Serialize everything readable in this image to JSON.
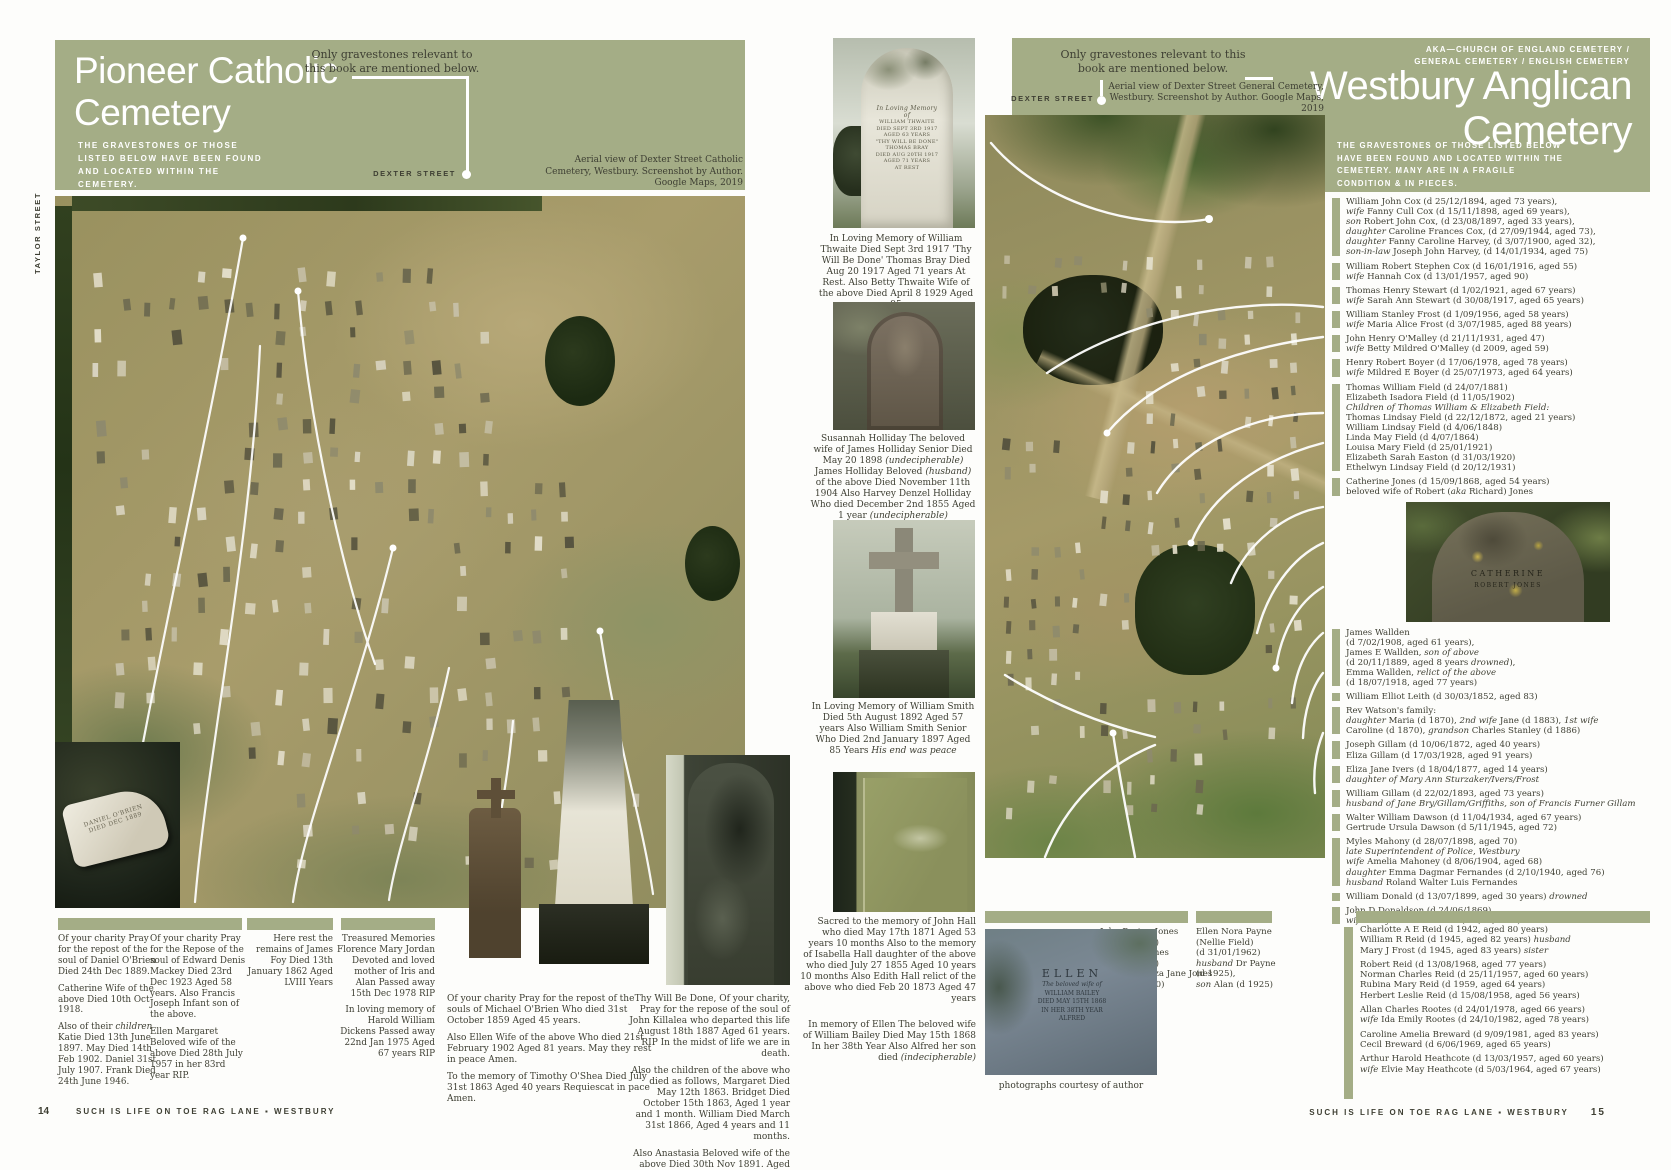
{
  "palette": {
    "sage": "#a4ad86",
    "ink": "#3e3f33",
    "annotation": "#ffffff"
  },
  "left_page": {
    "title": "Pioneer Catholic Cemetery",
    "callout": "Only gravestones relevant to this book are mentioned below.",
    "subtitle": "THE GRAVESTONES OF THOSE LISTED BELOW HAVE BEEN FOUND AND LOCATED WITHIN THE CEMETERY.",
    "street_side": "TAYLOR STREET",
    "street_bottom": "DEXTER STREET",
    "aerial_caption": "Aerial view of Dexter Street Catholic Cemetery, Westbury. Screenshot by Author. Google Maps, 2019",
    "fallen_stone_inscription": [
      "DANIEL O'BRIEN",
      "DIED DEC 1889"
    ],
    "caption_blocks": [
      {
        "paragraphs": [
          "Of your charity Pray for the repost of the soul of Daniel O'Brien Died 24th Dec 1889.",
          "Catherine Wife of the above Died 10th Oct 1918.",
          "Also of their *children* Katie Died 13th June 1897. May Died 14th Feb 1902. Daniel 31st July 1907. Frank Died 24th June 1946."
        ]
      },
      {
        "paragraphs": [
          "Of your charity Pray for the Repose of the soul of Edward Denis Mackey Died 23rd Dec 1923 Aged 58 years. Also Francis Joseph Infant son of the above.",
          "Ellen Margaret Beloved wife of the above Died 28th July 1957 in her 83rd year RIP."
        ]
      },
      {
        "paragraphs": [
          "Here rest the remains of James Foy Died 13th January 1862 Aged LVIII Years"
        ]
      },
      {
        "paragraphs": [
          "Treasured Memories Florence Mary Jordan Devoted and loved mother of Iris and Alan Passed away 15th Dec 1978 RIP",
          "In loving memory of Harold William Dickens Passed away 22nd Jan 1975 Aged 67 years RIP"
        ]
      },
      {
        "paragraphs": [
          "Of your charity Pray for the repost of the souls of Michael O'Brien Who died 31st October 1859 Aged 45 years.",
          "Also Ellen Wife of the above Who died 21st February 1902 Aged 81 years. May they rest in peace Amen.",
          "To the memory of Timothy O'Shea Died July 31st 1863 Aged 40 years Requiescat in pace Amen."
        ]
      },
      {
        "paragraphs": [
          "Thy Will Be Done, Of your charity, Pray for the repose of the soul of John Killalea who departed this life August 18th 1887 Aged 61 years. RIP In the midst of life we are in death.",
          "Also the children of the above who died as follows, Margaret Died May 12th 1863. Bridget Died October 15th 1863, Aged 1 year and 1 month. William Died March 31st 1866, Aged 4 years and 11 months.",
          "Also Anastasia Beloved wife of the above Died 30th Nov 1891. Aged 65 years."
        ]
      }
    ],
    "footer": {
      "page": "14",
      "text": "SUCH IS LIFE ON TOE RAG LANE ▪ WESTBURY"
    }
  },
  "right_page": {
    "aka1": "AKA—CHURCH OF ENGLAND CEMETERY /",
    "aka2": "GENERAL CEMETERY / ENGLISH CEMETERY",
    "title": "Westbury Anglican Cemetery",
    "subtitle": "THE GRAVESTONES OF THOSE LISTED BELOW HAVE BEEN FOUND AND LOCATED WITHIN THE CEMETERY. MANY ARE IN A FRAGILE CONDITION & IN PIECES.",
    "callout": "Only gravestones relevant to this book are mentioned below.",
    "street_top": "DEXTER STREET",
    "street_side": "MARY STREET",
    "aerial_caption": "Aerial view of Dexter Street General Cemetery, Westbury. Screenshot by Author. Google Maps, 2019",
    "thwaite_inscription": [
      "In Loving Memory",
      "of",
      "WILLIAM THWAITE",
      "DIED SEPT 3RD 1917",
      "AGED 63 YEARS",
      "\"THY WILL BE DONE\"",
      "THOMAS BRAY",
      "DIED AUG 20TH 1917",
      "AGED 71 YEARS",
      "AT REST"
    ],
    "ellen_inscription": [
      "ELLEN",
      "The beloved wife of",
      "WILLIAM BAILEY",
      "DIED MAY 15TH 1868",
      "IN HER 38TH YEAR",
      "ALFRED"
    ],
    "catherine_inscription": [
      "CATHERINE",
      "ROBERT JONES"
    ],
    "photo_captions": [
      {
        "paragraphs": [
          "In Loving Memory of William Thwaite Died Sept 3rd 1917 'Thy Will Be Done' Thomas Bray Died Aug 20 1917 Aged 71 years At Rest. Also Betty Thwaite Wife of the above Died April 8 1929 Aged 95"
        ]
      },
      {
        "paragraphs": [
          "Susannah Holliday The beloved wife of James Holliday Senior Died May 20 1898 *(undecipherable)* James Holliday Beloved *(husband)* of the above Died November 11th 1904 Also Harvey Denzel Holliday Who died December 2nd 1855 Aged 1 year *(undecipherable)*"
        ]
      },
      {
        "paragraphs": [
          "In Loving Memory of William Smith Died 5th August 1892 Aged 57 years Also William Smith Senior Who Died 2nd January 1897 Aged 85 Years *His end was peace*"
        ]
      },
      {
        "paragraphs": [
          "Sacred to the memory of John Hall who died May 17th 1871 Aged 53 years 10 months Also to the memory of Isabella Hall daughter of the above who died July 27 1855 Aged 10 years 10 months Also Edith Hall relict of the above who died Feb 20 1873 Aged 47 years"
        ]
      },
      {
        "paragraphs": [
          "In memory of Ellen The beloved wife of William Bailey Died May 15th 1868 In her 38th Year Also Alfred her son died *(indecipherable)*"
        ]
      }
    ],
    "list": [
      {
        "lines": [
          "William John Cox (d 25/12/1894, aged 73 years),",
          "*wife* Fanny Cull Cox (d 15/11/1898, aged 69 years),",
          "*son* Robert John Cox, (d 23/08/1897, aged 33 years),",
          "*daughter* Caroline Frances Cox, (d 27/09/1944, aged 73),",
          "*daughter* Fanny Caroline Harvey, (d 3/07/1900, aged 32),",
          "*son-in-law* Joseph John Harvey, (d 14/01/1934, aged 75)"
        ]
      },
      {
        "lines": [
          "William Robert Stephen Cox (d 16/01/1916, aged 55)",
          "*wife* Hannah Cox (d 13/01/1957, aged 90)"
        ]
      },
      {
        "lines": [
          "Thomas Henry Stewart (d 1/02/1921, aged 67 years)",
          "*wife* Sarah Ann Stewart (d 30/08/1917, aged 65 years)"
        ]
      },
      {
        "lines": [
          "William Stanley Frost (d 1/09/1956, aged 58 years)",
          "*wife* Maria Alice Frost (d 3/07/1985, aged 88 years)"
        ]
      },
      {
        "lines": [
          "John Henry O'Malley (d 21/11/1931, aged 47)",
          "*wife* Betty Mildred O'Malley (d 2009, aged 59)"
        ]
      },
      {
        "lines": [
          "Henry Robert Boyer (d 17/06/1978, aged 78 years)",
          "*wife* Mildred E Boyer (d 25/07/1973, aged 64 years)"
        ]
      },
      {
        "lines": [
          "Thomas William Field (d 24/07/1881)",
          "Elizabeth Isadora Field (d 11/05/1902)",
          "*Children of Thomas William & Elizabeth Field:*",
          "Thomas Lindsay Field (d 22/12/1872, aged 21 years)",
          "William Lindsay Field (d 4/06/1848)",
          "Linda May Field (d 4/07/1864)",
          "Louisa Mary Field (d 25/01/1921)",
          "Elizabeth Sarah Easton (d 31/03/1920)",
          "Ethelwyn Lindsay Field (d 20/12/1931)"
        ]
      },
      {
        "lines": [
          "Catherine Jones (d 15/09/1868, aged 54 years)",
          "beloved wife of Robert (*aka* Richard) Jones"
        ],
        "photo": "catherine"
      },
      {
        "lines": [
          "James Wallden",
          "(d 7/02/1908, aged 61 years),",
          "James E Wallden, *son of above*",
          "(d 20/11/1889, aged 8 years *drowned*),",
          "Emma Wallden, *relict of the above*",
          "(d 18/07/1918, aged 77 years)"
        ]
      },
      {
        "lines": [
          "William Elliot Leith (d 30/03/1852, aged 83)"
        ]
      },
      {
        "lines": [
          "Rev Watson's family:",
          "*daughter* Maria (d 1870), *2nd wife* Jane (d 1883), *1st wife*",
          "Caroline (d 1870), *grandson* Charles Stanley (d 1886)"
        ]
      },
      {
        "lines": [
          "Joseph Gillam (d 10/06/1872, aged 40 years)",
          "Eliza Gillam (d 17/03/1928, aged 91 years)"
        ]
      },
      {
        "lines": [
          "Eliza Jane Ivers (d 18/04/1877, aged 14 years)",
          "*daughter of Mary Ann Sturzaker/Ivers/Frost*"
        ]
      },
      {
        "lines": [
          "William Gillam (d 22/02/1893, aged 73 years)",
          "*husband of Jane Bry/Gillam/Griffiths, son of Francis Furner Gillam*"
        ]
      },
      {
        "lines": [
          "Walter William Dawson (d 11/04/1934, aged 67 years)",
          "Gertrude Ursula Dawson (d 5/11/1945, aged 72)"
        ]
      },
      {
        "lines": [
          "Myles Mahony (d 28/07/1898, aged 70)",
          "*late Superintendent of Police, Westbury*",
          "*wife* Amelia Mahoney (d 8/06/1904, aged 68)",
          "*daughter* Emma Dagmar Fernandes (d 2/10/1940, aged 76)",
          "*husband* Roland Walter Luis Fernandes"
        ]
      },
      {
        "lines": [
          "William Donald (d 13/07/1899, aged 30 years) *drowned*"
        ]
      },
      {
        "lines": [
          "John D Donaldson (d 24/06/1869)",
          "*wife* Mary Ann Donaldson (d 7/04/1887)"
        ]
      }
    ],
    "boxes": [
      {
        "lines": [
          "John Peyton Jones",
          "(d 2/11/1891)",
          "*wife* Eliza Jones",
          "(d 1/10/1880)",
          "*daughter* Eliza Jane Jones",
          "(d 24/06/1910)"
        ]
      },
      {
        "lines": [
          "Ellen Nora Payne",
          "(Nellie Field)",
          "(d 31/01/1962)",
          "*husband* Dr Payne",
          "(d 1925),",
          "*son* Alan (d 1925)"
        ]
      }
    ],
    "bottom_block": [
      {
        "lines": [
          "Charlotte A E Reid (d 1942, aged 80 years)",
          "William R Reid (d 1945, aged 82 years) *husband*",
          "Mary J Frost (d 1945, aged 83 years) *sister*"
        ]
      },
      {
        "lines": [
          "Robert Reid (d 13/08/1968, aged 77 years)",
          "Norman Charles Reid (d 25/11/1957, aged 60 years)",
          "Rubina Mary Reid (d 1959, aged 64 years)",
          "Herbert Leslie Reid (d 15/08/1958, aged 56 years)"
        ]
      },
      {
        "lines": [
          "Allan Charles Rootes (d 24/01/1978, aged 66 years)",
          "*wife* Ida Emily Rootes (d 24/10/1982, aged 78 years)"
        ]
      },
      {
        "lines": [
          "Caroline Amelia Breward (d 9/09/1981, aged 83 years)",
          "Cecil Breward (d 6/06/1969, aged 65 years)"
        ]
      },
      {
        "lines": [
          "Arthur Harold Heathcote (d 13/03/1957, aged 60 years)",
          "*wife* Elvie May Heathcote (d 5/03/1964, aged 67 years)"
        ]
      }
    ],
    "photo_credit": "photographs courtesy of author",
    "footer": {
      "text": "SUCH IS LIFE ON TOE RAG LANE ▪ WESTBURY",
      "page": "15"
    }
  }
}
